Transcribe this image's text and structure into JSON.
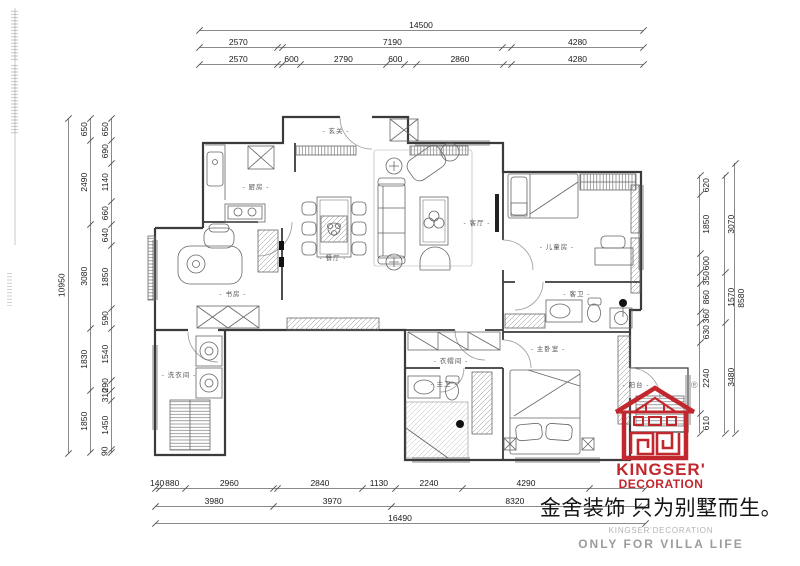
{
  "dimensions": {
    "top": {
      "row1": [
        14500
      ],
      "row2": [
        2570,
        {
          "v": 150,
          "b": 1
        },
        7190,
        {
          "v": 310,
          "b": 1
        },
        4280
      ],
      "row3": [
        2570,
        {
          "v": 150,
          "b": 1
        },
        600,
        2790,
        600,
        {
          "v": 380,
          "b": 1
        },
        2860,
        {
          "v": 270,
          "b": 1
        },
        4280
      ]
    },
    "left": {
      "outer": [
        10950
      ],
      "middle": [
        650,
        2490,
        3080,
        1830,
        1850
      ],
      "inner": [
        650,
        690,
        1140,
        660,
        640,
        1850,
        590,
        1540,
        290,
        310,
        1450,
        90
      ]
    },
    "right": {
      "inner": [
        620,
        1850,
        600,
        350,
        860,
        360,
        630,
        2240,
        610
      ],
      "middle": [
        3070,
        1570,
        3480
      ],
      "outer": [
        8580
      ]
    },
    "bottom": {
      "row1": [
        140,
        880,
        2960,
        {
          "v": 150,
          "b": 1
        },
        2840,
        1130,
        2240,
        4290,
        {
          "v": 1860,
          "b": 1
        }
      ],
      "row2": [
        3980,
        3970,
        8320,
        {
          "v": 220,
          "b": 1
        }
      ],
      "row3": [
        16490
      ]
    }
  },
  "rooms": [
    {
      "label": "- 玄关 -"
    },
    {
      "label": "- 厨房 -"
    },
    {
      "label": "- 餐厅 -"
    },
    {
      "label": "- 客厅 -"
    },
    {
      "label": "- 儿童房 -"
    },
    {
      "label": "- 书房 -"
    },
    {
      "label": "- 客卫 -"
    },
    {
      "label": "- 洗衣间 -"
    },
    {
      "label": "- 衣帽间 -"
    },
    {
      "label": "- 主卫 -"
    },
    {
      "label": "- 主卧室 -"
    },
    {
      "label": "- 阳台 -"
    }
  ],
  "logo": {
    "brand_line1": "KINGSER'",
    "brand_line2": "DECORATION",
    "registered": "®",
    "color": "#c2272d"
  },
  "footer": {
    "slogan_cn": "金舍装饰 只为别墅而生。",
    "brand_en": "KINGSER'DECORATION",
    "tagline_en": "ONLY FOR VILLA LIFE"
  }
}
